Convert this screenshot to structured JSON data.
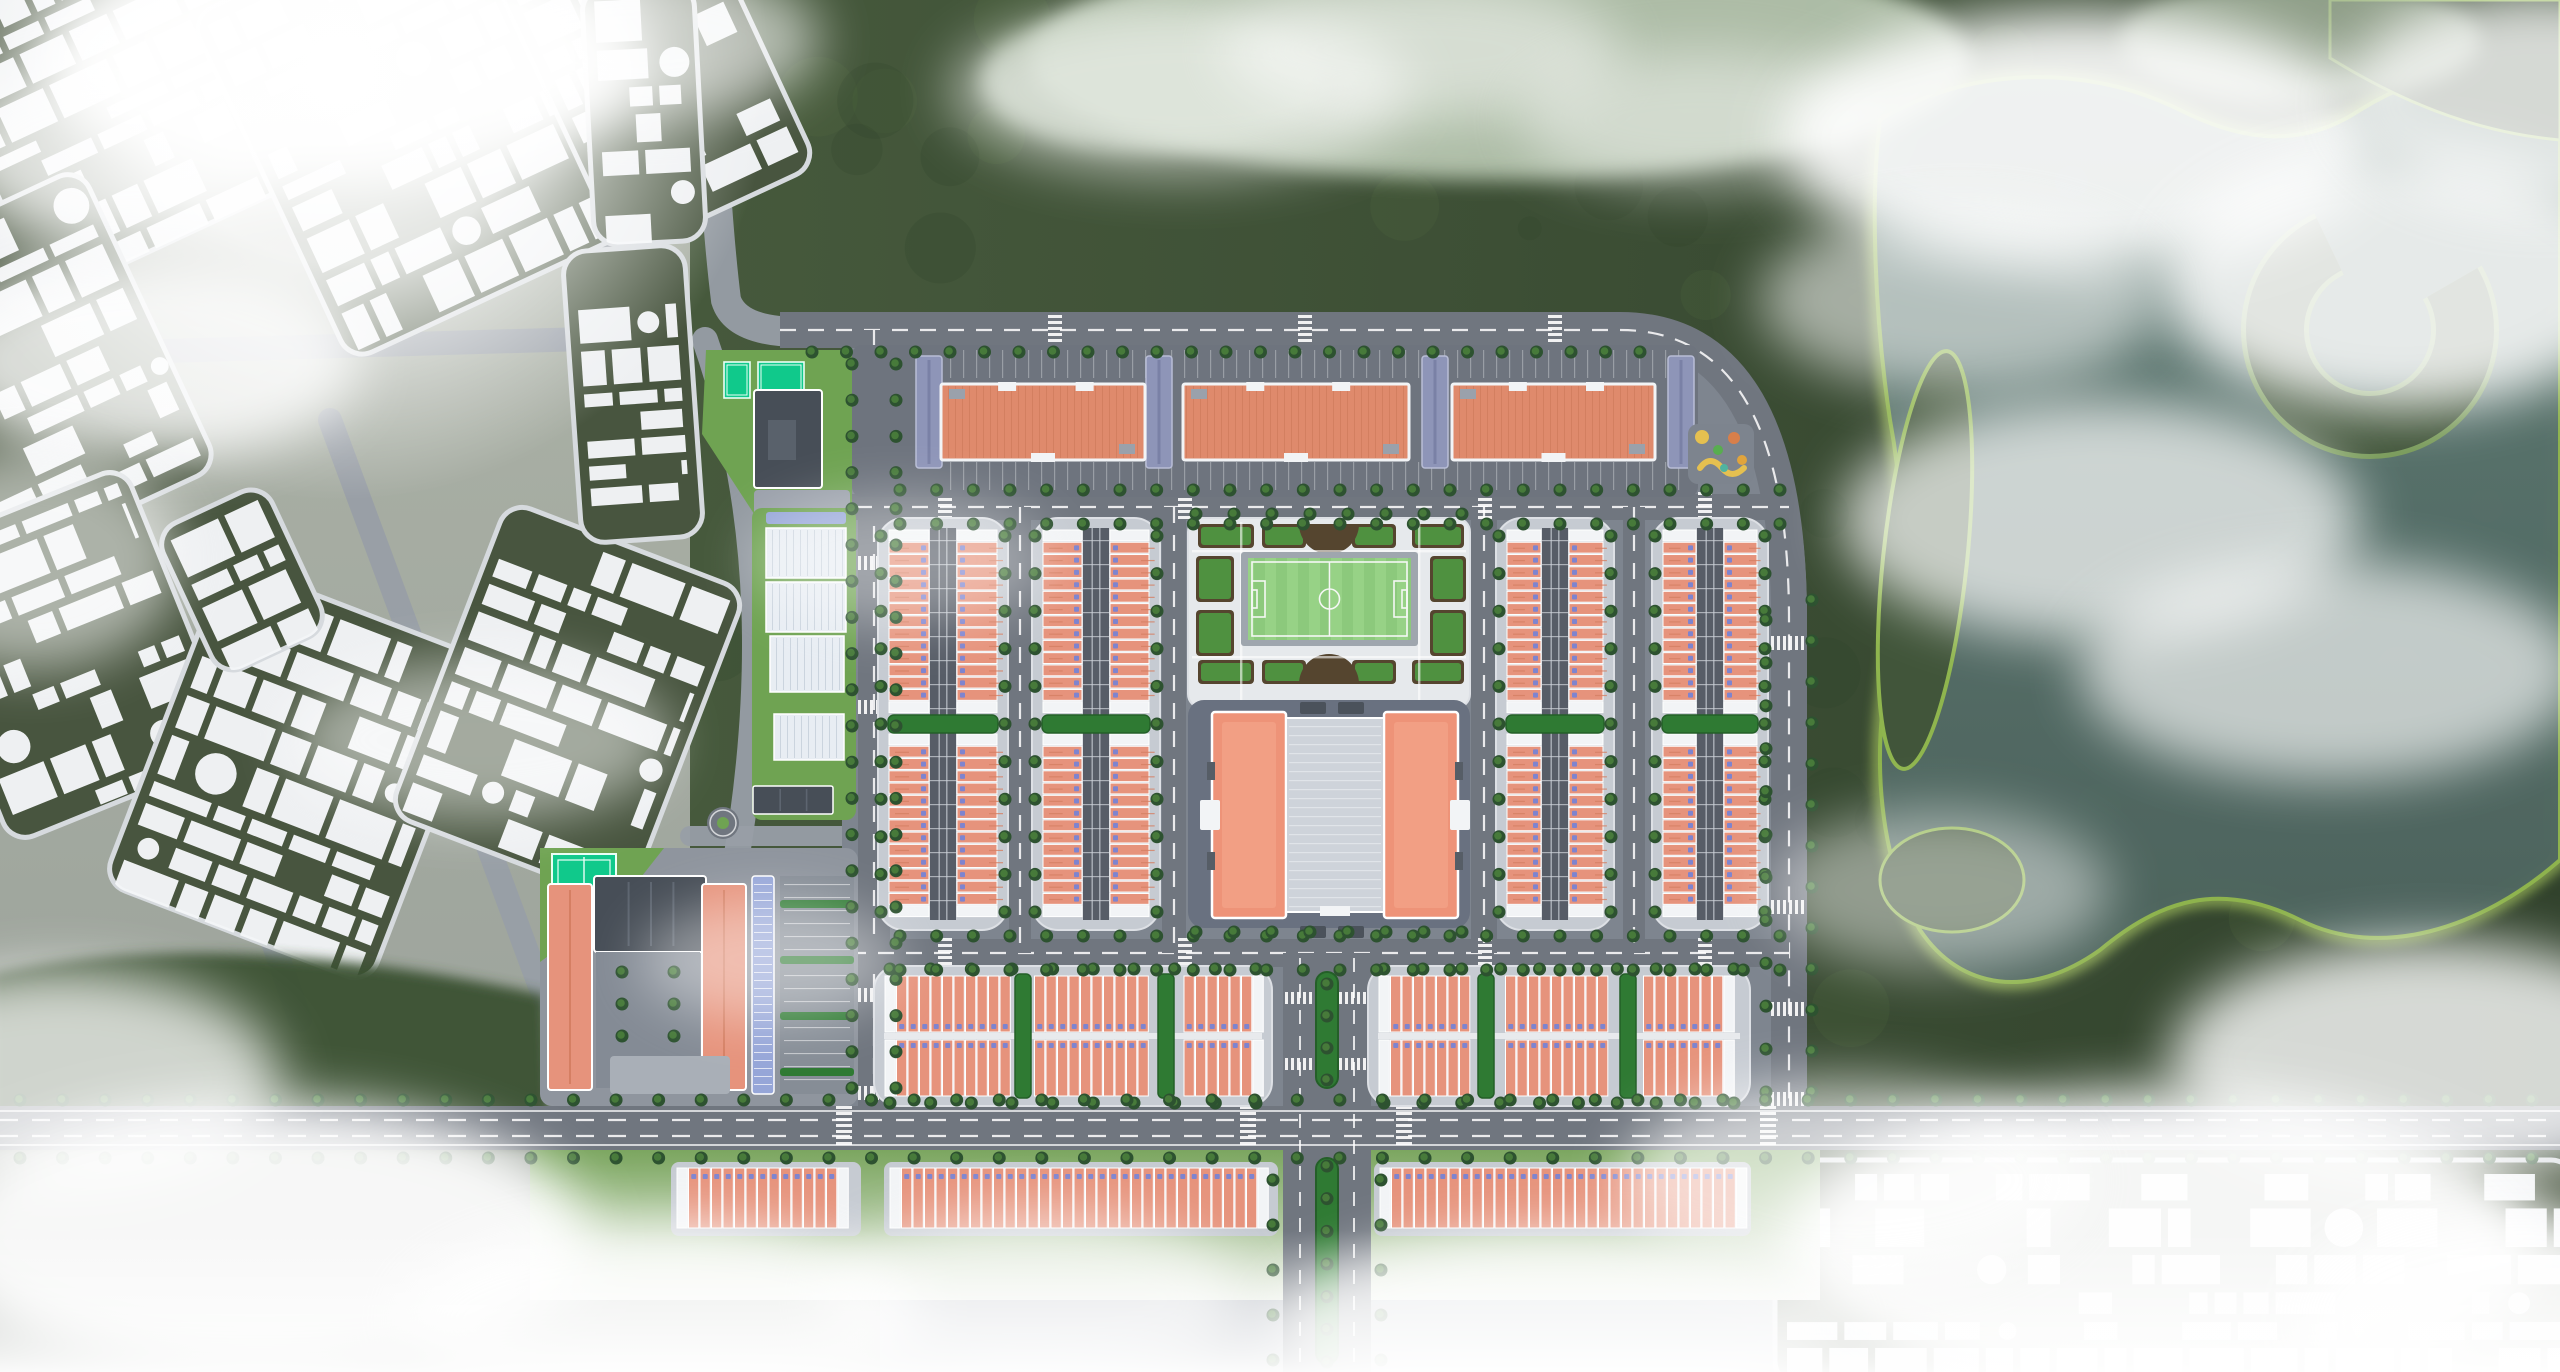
{
  "meta": {
    "label": "Aerial masterplan rendering: terracotta-roofed row-house development with central football pitch and community building, existing white schematic city blocks to the west, forested hills and a lake to the east, drifting clouds and fog",
    "canvas": {
      "w": 2560,
      "h": 1372
    }
  },
  "palette": {
    "base": "#b6bbc2",
    "cityTint": "#a6ac9f",
    "blockGreen": "#48553f",
    "blockGreenDark": "#3f4c39",
    "building": "#f4f6f8",
    "forest1": "#41553a",
    "forest2": "#31422c",
    "forestEdge": "#8fb54e",
    "forestEdgeBright": "#aece62",
    "water1": "#607c75",
    "water2": "#4d645e",
    "lagoon": "#b7c6b0",
    "road": "#70767f",
    "roadLight": "#989ea6",
    "roadLine": "#ffffff",
    "devGround": "#7e858f",
    "pad": "#c6cbd2",
    "padEdge": "#dde0e5",
    "alley": "#575d67",
    "roofSalmon": "#e6937c",
    "roofSalmonDark": "#d57f63",
    "roofCap": "#f2f4f6",
    "doorBlue": "#7e84cf",
    "hedge": "#2f7a33",
    "hedgeDark": "#245f28",
    "apartmentRoof": "#df8a6c",
    "apartmentHatch": "#cf7a5c",
    "wing": "#8e95b8",
    "pitchGreen": "#8cc97c",
    "pitchStripe": "#97d286",
    "pitchLine": "#f5f7f5",
    "gardenPath": "#e6e9ec",
    "soil": "#55452f",
    "bedGreen": "#4f9140",
    "plaza": "#697180",
    "centerRoof": "#ee9378",
    "centerRoofLight": "#f5a78c",
    "atrium": "#ced3da",
    "darkTab": "#4b525b",
    "slateRoof": "#474e57",
    "slateRidge": "#5d6570",
    "court": "#10c98b",
    "courtLine": "#eafff6",
    "canopy": "#96a6d8",
    "shed": "#e8edf3",
    "shedLine": "#c3cdd8",
    "lawn": "#6fa352",
    "lawnDark": "#3a5133",
    "tree1": "#2d5230",
    "tree2": "#477a3a",
    "playBase": "#7d848e",
    "playYellow": "#e5c050",
    "playOrange": "#d87f4a",
    "playGreen": "#58ad4f",
    "playTeal": "#4fb3a0",
    "cloud": "#ffffff"
  },
  "nature": {
    "forestBase": [
      690,
      0,
      1870,
      1160
    ],
    "lake": "M 1880,120 C 1960,70 2080,60 2180,110 C 2240,140 2300,150 2360,110 C 2440,60 2520,60 2560,90 L 2560,860 C 2480,930 2380,960 2300,920 C 2220,880 2160,900 2100,950 C 2030,1000 1960,990 1920,930 C 1880,860 1870,760 1890,660 C 1905,580 1905,500 1890,420 C 1875,320 1870,200 1880,120 Z",
    "island": "M 2330,0 L 2560,0 L 2560,140 C 2470,132 2395,98 2330,58 Z",
    "cRidge": {
      "cx": 2370,
      "cy": 330,
      "r": 95,
      "w": 58,
      "dash": "455 142",
      "rot": -30
    },
    "peninsula": [
      1925,
      560,
      42,
      210,
      6
    ],
    "blob": [
      1952,
      880,
      72,
      52
    ],
    "lagoons": [
      [
        1500,
        60,
        470,
        120,
        0.92
      ],
      [
        1150,
        80,
        170,
        72,
        0.8
      ],
      [
        2300,
        40,
        180,
        62,
        0.7
      ]
    ],
    "leftForest": "M -10,975 C 160,935 360,955 545,995 L 552,1146 L -10,1146 Z",
    "lawnBand": [
      530,
      1148,
      1290,
      152
    ],
    "texSeed": 11
  },
  "city": {
    "seed": 7,
    "blocks": [
      [
        -40,
        -90,
        310,
        340,
        -25
      ],
      [
        255,
        -70,
        330,
        380,
        -25
      ],
      [
        545,
        -95,
        215,
        320,
        -25
      ],
      [
        -70,
        200,
        230,
        330,
        -25
      ],
      [
        -55,
        500,
        245,
        310,
        -22
      ],
      [
        155,
        600,
        285,
        345,
        21
      ],
      [
        440,
        535,
        255,
        335,
        21
      ],
      [
        182,
        500,
        120,
        160,
        -25
      ],
      [
        588,
        -15,
        112,
        258,
        -3
      ],
      [
        572,
        248,
        122,
        292,
        -4
      ],
      [
        1775,
        1160,
        800,
        225,
        0
      ]
    ],
    "roads": [
      {
        "d": "M 703,-10 C 712,120 716,220 726,300 Q 736,332 800,332",
        "w": 30
      },
      {
        "d": "M 598,-10 C 606,120 610,220 618,300 Q 622,336 560,340",
        "w": 22
      },
      {
        "d": "M -10,356 L 620,338",
        "w": 24
      },
      {
        "d": "M 95,430 L 300,1020",
        "w": 24
      },
      {
        "d": "M 330,420 L 545,1000",
        "w": 24
      },
      {
        "d": "M 545,1000 Q 620,1080 700,1108",
        "w": 24
      },
      {
        "d": "M 705,340 C 768,520 764,700 734,872 C 716,975 688,1060 660,1128",
        "w": 26
      },
      {
        "d": "M 690,836 L 874,836",
        "w": 20
      }
    ]
  },
  "roads": {
    "ground": "M 842,314 L 1600,314 Q 1807,314 1807,618 L 1807,1112 L 842,1112 Z",
    "main": [
      {
        "name": "top-ring-road",
        "d": "M 780,330 L 1620,330 Q 1789,330 1789,620 L 1789,1110",
        "w": 36,
        "dash": true
      },
      {
        "name": "west-avenue",
        "d": "M 874,330 L 874,1130",
        "w": 32,
        "dash": true
      },
      {
        "name": "mid-street",
        "d": "M 800,507 L 1789,507",
        "w": 26,
        "dash": true
      },
      {
        "name": "south-street",
        "d": "M 850,953 L 1789,953",
        "w": 28,
        "dash": true
      },
      {
        "name": "lane-1",
        "d": "M 1020,507 L 1020,953",
        "w": 22,
        "dash": true
      },
      {
        "name": "lane-2",
        "d": "M 1174,507 L 1174,953",
        "w": 24,
        "dash": true
      },
      {
        "name": "lane-3",
        "d": "M 1484,507 L 1484,953",
        "w": 26,
        "dash": true
      },
      {
        "name": "lane-4",
        "d": "M 1634,507 L 1634,953",
        "w": 22,
        "dash": true
      },
      {
        "name": "boulevard",
        "d": "M 1327,953 L 1327,1372",
        "w": 88,
        "dash": false
      },
      {
        "name": "arterial",
        "d": "M 0,1128 L 2560,1128",
        "w": 44,
        "dash": false
      }
    ],
    "arterialLines": [
      1111,
      1145
    ],
    "arterialDashes": [
      1120,
      1136
    ],
    "boulevardDashes": [
      1300,
      1354
    ],
    "crosswalks": [
      [
        938,
        492,
        14,
        30,
        "h"
      ],
      [
        1178,
        492,
        14,
        30,
        "h"
      ],
      [
        1478,
        492,
        14,
        30,
        "h"
      ],
      [
        1698,
        492,
        14,
        30,
        "h"
      ],
      [
        938,
        938,
        14,
        30,
        "h"
      ],
      [
        1178,
        938,
        14,
        30,
        "h"
      ],
      [
        1478,
        938,
        14,
        30,
        "h"
      ],
      [
        1698,
        938,
        14,
        30,
        "h"
      ],
      [
        1048,
        315,
        14,
        30,
        "h"
      ],
      [
        1298,
        315,
        14,
        30,
        "h"
      ],
      [
        1548,
        315,
        14,
        30,
        "h"
      ],
      [
        858,
        556,
        32,
        14,
        "v"
      ],
      [
        858,
        700,
        32,
        14,
        "v"
      ],
      [
        858,
        988,
        32,
        14,
        "v"
      ],
      [
        858,
        1086,
        32,
        14,
        "v"
      ],
      [
        1771,
        636,
        36,
        14,
        "v"
      ],
      [
        1771,
        900,
        36,
        14,
        "v"
      ],
      [
        1771,
        1002,
        36,
        14,
        "v"
      ],
      [
        1771,
        1092,
        36,
        14,
        "v"
      ],
      [
        836,
        1106,
        16,
        44,
        "h"
      ],
      [
        1240,
        1106,
        16,
        44,
        "h"
      ],
      [
        1396,
        1106,
        16,
        44,
        "h"
      ],
      [
        1760,
        1106,
        16,
        44,
        "h"
      ],
      [
        1285,
        992,
        86,
        12,
        "v"
      ],
      [
        1285,
        1058,
        86,
        12,
        "v"
      ]
    ],
    "treelines": [
      [
        812,
        352,
        1640,
        352,
        34
      ],
      [
        900,
        490,
        1780,
        490,
        36
      ],
      [
        900,
        524,
        1780,
        524,
        36
      ],
      [
        900,
        936,
        1780,
        936,
        36
      ],
      [
        900,
        970,
        1780,
        970,
        36
      ],
      [
        852,
        364,
        852,
        1088,
        36
      ],
      [
        896,
        364,
        896,
        1088,
        36
      ],
      [
        1766,
        620,
        1766,
        1092,
        40
      ],
      [
        1812,
        600,
        1812,
        1092,
        40
      ],
      [
        20,
        1100,
        2532,
        1100,
        42
      ],
      [
        20,
        1158,
        2532,
        1158,
        42
      ],
      [
        1273,
        1180,
        1273,
        1360,
        44
      ],
      [
        1381,
        1180,
        1381,
        1360,
        44
      ],
      [
        1196,
        514,
        1462,
        514,
        34
      ],
      [
        1196,
        932,
        1462,
        932,
        34
      ],
      [
        1327,
        984,
        1327,
        1080,
        26
      ],
      [
        1327,
        1166,
        1327,
        1362,
        30
      ]
    ]
  },
  "development": {
    "apartmentPad": [
      852,
      345,
      846,
      152
    ],
    "slabs": [
      [
        941,
        384,
        204,
        76
      ],
      [
        1183,
        384,
        226,
        76
      ],
      [
        1452,
        384,
        203,
        76
      ]
    ],
    "wings": [
      [
        916,
        356,
        26,
        112
      ],
      [
        1146,
        356,
        26,
        112
      ],
      [
        1422,
        356,
        26,
        112
      ],
      [
        1668,
        356,
        26,
        112
      ]
    ],
    "stallBands": [
      [
        950,
        350,
        740,
        28
      ],
      [
        950,
        462,
        740,
        28
      ]
    ],
    "playground": [
      1688,
      424,
      66,
      60
    ],
    "rowBlocksV": [
      {
        "x": 878,
        "y": 518,
        "w": 130,
        "h": 412,
        "units": 15
      },
      {
        "x": 1032,
        "y": 518,
        "w": 128,
        "h": 412,
        "units": 15
      },
      {
        "x": 1496,
        "y": 518,
        "w": 118,
        "h": 412,
        "units": 15
      },
      {
        "x": 1652,
        "y": 518,
        "w": 116,
        "h": 412,
        "units": 15
      }
    ],
    "garden": {
      "pad": [
        1188,
        518,
        282,
        190
      ],
      "pitchFrame": [
        1241,
        552,
        177,
        94
      ],
      "pitchField": [
        1248,
        558,
        163,
        82
      ],
      "beds": [
        [
          1198,
          524,
          56,
          24
        ],
        [
          1262,
          524,
          44,
          24
        ],
        [
          1352,
          524,
          44,
          24
        ],
        [
          1412,
          524,
          52,
          24
        ],
        [
          1198,
          660,
          56,
          24
        ],
        [
          1262,
          660,
          44,
          24
        ],
        [
          1352,
          660,
          44,
          24
        ],
        [
          1412,
          660,
          52,
          24
        ],
        [
          1196,
          556,
          38,
          46
        ],
        [
          1196,
          610,
          38,
          46
        ],
        [
          1430,
          556,
          36,
          46
        ],
        [
          1430,
          610,
          36,
          46
        ]
      ],
      "semiTop": "M 1299,524 a 30,30 0 0 0 60,0 Z",
      "semiBottom": "M 1299,684 a 30,30 0 0 1 60,0 Z",
      "gridH": [
        550,
        656
      ],
      "gridV": [
        1240,
        1418
      ]
    },
    "plaza": [
      1188,
      700,
      282,
      228
    ],
    "centerBuilding": {
      "wings": [
        [
          1212,
          712,
          74,
          206
        ],
        [
          1384,
          712,
          74,
          206
        ]
      ],
      "atrium": [
        1286,
        718,
        98,
        194
      ],
      "tabs": [
        [
          1300,
          702,
          26,
          12
        ],
        [
          1338,
          702,
          26,
          12
        ],
        [
          1300,
          926,
          26,
          12
        ],
        [
          1338,
          926,
          26,
          12
        ]
      ]
    },
    "rowBlocksH": [
      {
        "x": 874,
        "y": 966,
        "w": 398,
        "h": 140,
        "hedges": [
          1015,
          1158
        ]
      },
      {
        "x": 1368,
        "y": 966,
        "w": 382,
        "h": 140,
        "hedges": [
          1478,
          1620
        ]
      }
    ],
    "singleRows": [
      [
        677,
        1168,
        178,
        60
      ],
      [
        890,
        1168,
        382,
        60
      ],
      [
        1380,
        1168,
        365,
        60
      ]
    ],
    "medians": [
      [
        1316,
        972,
        22,
        116
      ],
      [
        1316,
        1158,
        22,
        206
      ]
    ],
    "school": {
      "pad": [
        540,
        848,
        318,
        258
      ],
      "lawn": "M 540,848 L 664,848 L 620,904 L 540,962 Z",
      "court": [
        552,
        854,
        64,
        40
      ],
      "hall": [
        594,
        876,
        112,
        76
      ],
      "wingL": [
        548,
        884,
        44,
        206
      ],
      "wingR": [
        702,
        884,
        44,
        206
      ],
      "courtyard": [
        596,
        952,
        104,
        136
      ],
      "canopy": [
        752,
        876,
        22,
        218
      ],
      "parking": [
        780,
        876,
        74,
        218
      ],
      "hedges": [
        [
          780,
          900,
          74,
          8
        ],
        [
          780,
          956,
          74,
          8
        ],
        [
          780,
          1012,
          74,
          8
        ],
        [
          780,
          1068,
          74,
          8
        ]
      ],
      "steps": [
        632,
        952,
        36,
        8
      ],
      "entrance": [
        610,
        1056,
        120,
        38
      ],
      "roundabout": [
        723,
        823,
        16
      ]
    },
    "nwParcel": {
      "lawn": "M 706,350 L 852,350 L 852,520 L 758,520 L 702,434 Z",
      "courts": [
        [
          724,
          362,
          26,
          36
        ],
        [
          758,
          362,
          46,
          36
        ]
      ],
      "building": [
        754,
        390,
        68,
        98
      ],
      "inner": [
        768,
        420,
        28,
        40
      ],
      "plaza": [
        754,
        490,
        96,
        30
      ]
    },
    "greenhouses": {
      "lawn": [
        752,
        508,
        104,
        312
      ],
      "canopy": [
        766,
        512,
        80,
        12
      ],
      "sheds": [
        [
          766,
          528,
          80,
          50
        ],
        [
          766,
          582,
          80,
          50
        ],
        [
          770,
          636,
          74,
          56
        ],
        [
          774,
          714,
          70,
          46
        ]
      ],
      "darkBuilding": [
        753,
        786,
        80,
        28
      ]
    }
  },
  "clouds": [
    [
      340,
      60,
      300,
      120,
      0.95
    ],
    [
      120,
      150,
      170,
      90,
      0.7
    ],
    [
      640,
      40,
      180,
      80,
      0.6
    ],
    [
      150,
      360,
      210,
      100,
      0.8
    ],
    [
      30,
      560,
      150,
      110,
      0.55
    ],
    [
      480,
      740,
      190,
      80,
      0.5
    ],
    [
      60,
      1080,
      220,
      110,
      0.75
    ],
    [
      260,
      1240,
      330,
      140,
      0.92
    ],
    [
      660,
      1320,
      260,
      100,
      0.8
    ],
    [
      1030,
      1300,
      210,
      90,
      0.6
    ],
    [
      1180,
      90,
      230,
      85,
      0.55
    ],
    [
      1420,
      50,
      200,
      70,
      0.5
    ],
    [
      1700,
      120,
      180,
      70,
      0.45
    ],
    [
      2080,
      140,
      300,
      130,
      0.9
    ],
    [
      2400,
      280,
      240,
      130,
      0.85
    ],
    [
      2540,
      100,
      200,
      110,
      0.8
    ],
    [
      1960,
      300,
      200,
      90,
      0.55
    ],
    [
      2100,
      520,
      260,
      120,
      0.7
    ],
    [
      2330,
      670,
      250,
      110,
      0.65
    ],
    [
      1940,
      890,
      170,
      80,
      0.45
    ],
    [
      2430,
      1060,
      260,
      120,
      0.8
    ],
    [
      2160,
      1250,
      380,
      160,
      0.95
    ],
    [
      2520,
      1320,
      220,
      110,
      0.9
    ],
    [
      1850,
      1180,
      230,
      100,
      0.65
    ],
    [
      1560,
      1330,
      290,
      100,
      0.75
    ],
    [
      900,
      560,
      150,
      65,
      0.35
    ],
    [
      770,
      960,
      130,
      60,
      0.4
    ]
  ],
  "glare": {
    "cx": 340,
    "cy": 70,
    "r": 430
  },
  "bottomFog": [
    0,
    1230,
    2560,
    142
  ]
}
